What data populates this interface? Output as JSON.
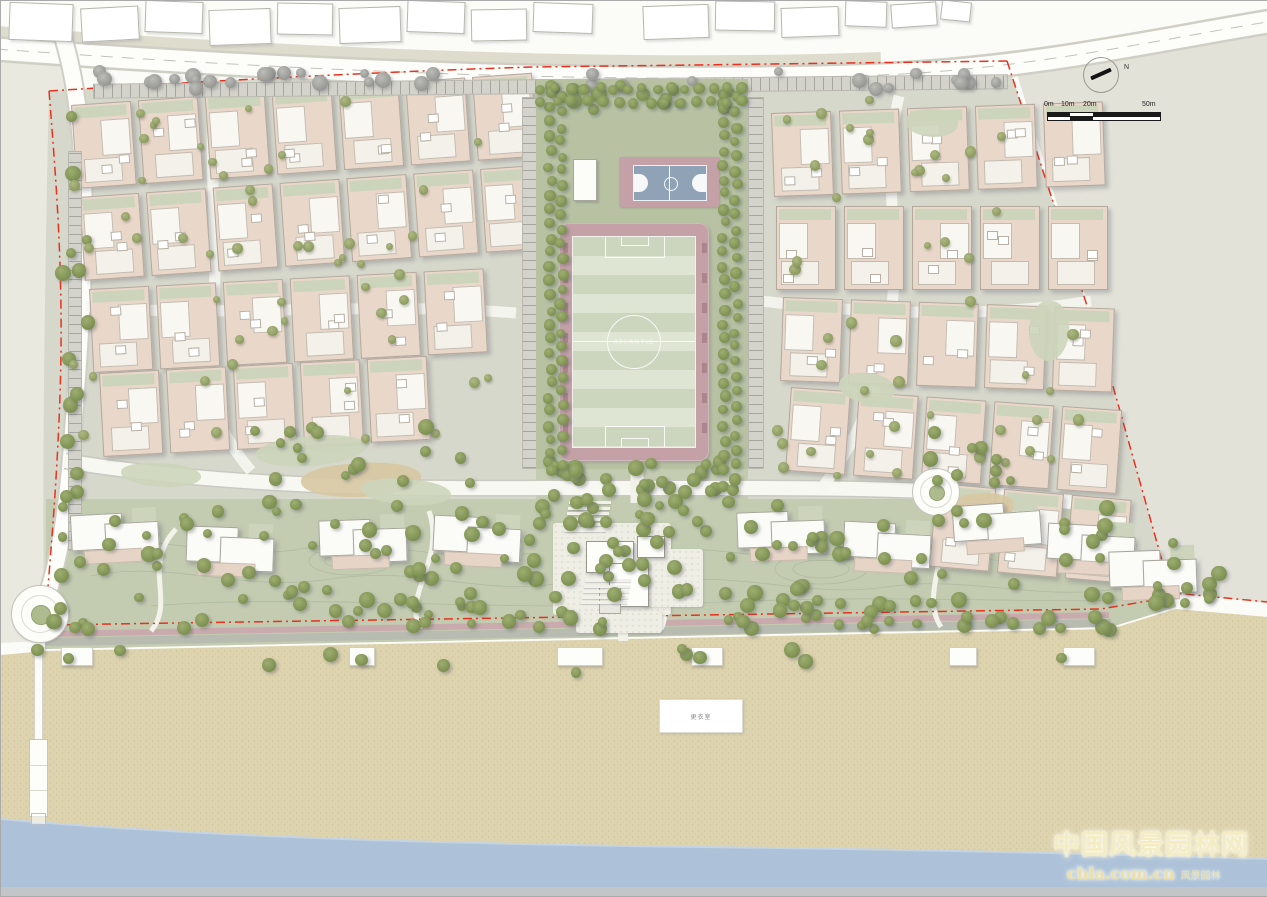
{
  "annotations": {
    "north_label": "N",
    "scale_labels": [
      "0m",
      "10m",
      "20m",
      "50m"
    ]
  },
  "watermark": {
    "line1": "中国风景园林网",
    "line2": "chla.com.cn",
    "line3": "风景园林"
  },
  "labels": {
    "beach_box": "更衣室",
    "field_center": "ATLANTIS"
  },
  "colors": {
    "boundary_red": "#e8321e",
    "sea": "#adc2d8",
    "sand": "#ddd3ae",
    "green_band": "#c3cbb1",
    "strip_green": "#b8c2a3",
    "track_mauve": "#c3a1a7",
    "court_blue": "#8fa2b6",
    "house_beige": "#e9d7ca",
    "tree_green": "#7c9050",
    "tree_gray": "#9a9a96",
    "paving": "#d7d8cc",
    "offsite": "#e2e2d9",
    "promenade": "#c9abae",
    "road": "#fdfdfa"
  },
  "map": {
    "house": {
      "w": 58,
      "h": 82
    },
    "existing_buildings": [
      [
        8,
        2,
        62,
        36,
        2
      ],
      [
        80,
        6,
        56,
        32,
        -3
      ],
      [
        144,
        0,
        56,
        30,
        2
      ],
      [
        208,
        8,
        60,
        34,
        -2
      ],
      [
        276,
        2,
        54,
        30,
        1
      ],
      [
        338,
        6,
        60,
        34,
        -2
      ],
      [
        406,
        0,
        56,
        30,
        2
      ],
      [
        470,
        8,
        54,
        30,
        -1
      ],
      [
        532,
        2,
        58,
        28,
        2
      ],
      [
        642,
        4,
        64,
        32,
        -2
      ],
      [
        714,
        0,
        58,
        28,
        1
      ],
      [
        780,
        6,
        56,
        28,
        -2
      ],
      [
        844,
        0,
        40,
        24,
        2
      ],
      [
        890,
        2,
        44,
        22,
        -4
      ],
      [
        940,
        0,
        28,
        18,
        6
      ]
    ],
    "clusters": [
      {
        "name": "west",
        "rows": [
          [
            70,
            104,
            -4,
            [
              0,
              67,
              134,
              201,
              268,
              335,
              402
            ]
          ],
          [
            78,
            196,
            -4,
            [
              0,
              67,
              134,
              201,
              268,
              335,
              402
            ]
          ],
          [
            88,
            288,
            -3,
            [
              0,
              67,
              134,
              201,
              268,
              335
            ]
          ],
          [
            98,
            372,
            -3,
            [
              0,
              67,
              134,
              201,
              268
            ]
          ]
        ]
      },
      {
        "name": "east",
        "rows": [
          [
            770,
            112,
            -2,
            [
              0,
              68,
              136,
              204,
              272
            ]
          ],
          [
            775,
            205,
            0,
            [
              0,
              68,
              136,
              204,
              272
            ]
          ],
          [
            782,
            296,
            2,
            [
              0,
              68,
              136,
              204,
              272
            ]
          ],
          [
            790,
            386,
            4,
            [
              0,
              68,
              136,
              204,
              272
            ]
          ],
          [
            800,
            470,
            5,
            [
              136,
              204,
              272
            ]
          ]
        ]
      }
    ],
    "condos": [
      [
        70,
        508,
        -3
      ],
      [
        185,
        522,
        2
      ],
      [
        318,
        514,
        -2
      ],
      [
        432,
        512,
        3
      ],
      [
        736,
        506,
        -2
      ],
      [
        842,
        518,
        3
      ],
      [
        952,
        498,
        -4
      ],
      [
        1046,
        520,
        3
      ],
      [
        1108,
        545,
        -2
      ]
    ],
    "patches": [
      [
        300,
        462,
        120,
        34,
        -4,
        "#d7c8a2"
      ],
      [
        255,
        435,
        110,
        30,
        -6,
        "#ccd5ba"
      ],
      [
        360,
        478,
        90,
        26,
        3,
        "#ccd5ba"
      ],
      [
        952,
        492,
        62,
        26,
        -2,
        "#d7c8a2"
      ],
      [
        905,
        108,
        52,
        28,
        0,
        "#ccd5ba"
      ],
      [
        838,
        372,
        56,
        30,
        4,
        "#ccd5ba"
      ],
      [
        120,
        462,
        80,
        24,
        2,
        "#ccd5ba"
      ],
      [
        1028,
        300,
        40,
        60,
        8,
        "#ccd5ba"
      ]
    ],
    "tree_belts": [
      [
        95,
        70,
        905,
        18,
        34,
        "gray"
      ],
      [
        58,
        115,
        30,
        430,
        14,
        "green"
      ],
      [
        540,
        84,
        200,
        26,
        16,
        "green"
      ],
      [
        70,
        100,
        435,
        360,
        52,
        "yard"
      ],
      [
        768,
        95,
        330,
        400,
        46,
        "yard"
      ],
      [
        50,
        500,
        1060,
        100,
        110,
        "green"
      ],
      [
        50,
        597,
        1085,
        32,
        70,
        "green"
      ],
      [
        1148,
        540,
        75,
        72,
        12,
        "green"
      ],
      [
        30,
        646,
        1060,
        26,
        14,
        "green"
      ],
      [
        548,
        460,
        186,
        42,
        36,
        "green"
      ],
      [
        545,
        500,
        155,
        115,
        14,
        "green"
      ],
      [
        248,
        425,
        240,
        60,
        16,
        "green"
      ],
      [
        905,
        430,
        120,
        60,
        10,
        "green"
      ]
    ],
    "tree_rows": [
      [
        549,
        92,
        549,
        468,
        27
      ],
      [
        561,
        97,
        561,
        463,
        26
      ],
      [
        723,
        92,
        723,
        468,
        27
      ],
      [
        735,
        97,
        735,
        463,
        26
      ],
      [
        540,
        88,
        742,
        88,
        15
      ],
      [
        540,
        101,
        742,
        101,
        14
      ]
    ],
    "beach_stairs": [
      [
        60,
        30
      ],
      [
        348,
        24
      ],
      [
        556,
        44
      ],
      [
        690,
        30
      ],
      [
        948,
        26
      ],
      [
        1062,
        30
      ]
    ]
  }
}
